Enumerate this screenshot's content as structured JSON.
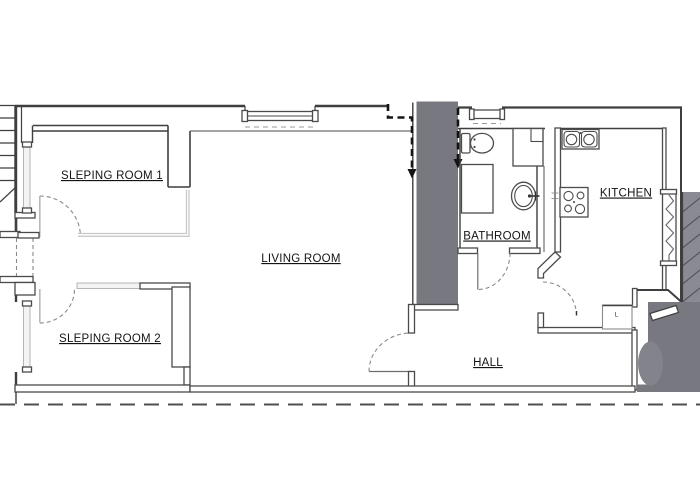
{
  "rooms": {
    "sleeping_room_1": {
      "label": "SLEPING ROOM 1"
    },
    "sleeping_room_2": {
      "label": "SLEPING ROOM 2"
    },
    "living_room": {
      "label": "LIVING ROOM"
    },
    "bathroom": {
      "label": "BATHROOM"
    },
    "kitchen": {
      "label": "KITCHEN"
    },
    "hall": {
      "label": "HALL"
    }
  },
  "annotations": {
    "closet_label": "L"
  },
  "fixtures": [
    "toilet",
    "washbasin",
    "shower-tray",
    "shower-cabin",
    "kitchen-double-sink",
    "stove-4-burners",
    "wardrobe-l",
    "window-sleeping-room-1",
    "window-sleeping-room-2",
    "window-living-room",
    "window-bathroom",
    "window-kitchen",
    "staircase-top-left",
    "staircase-exterior-right",
    "entrance-landing"
  ],
  "colors": {
    "wall": "#3f3f3f",
    "shaft_fill": "#787881",
    "exterior_stair_fill": "#8a8a92",
    "landing_fill": "#787881",
    "light_partition": "#c9c9c9",
    "background": "#ffffff"
  },
  "linework": {
    "section_line_style": "dashed-with-arrow",
    "boundary_line_style": "long-dashed"
  }
}
